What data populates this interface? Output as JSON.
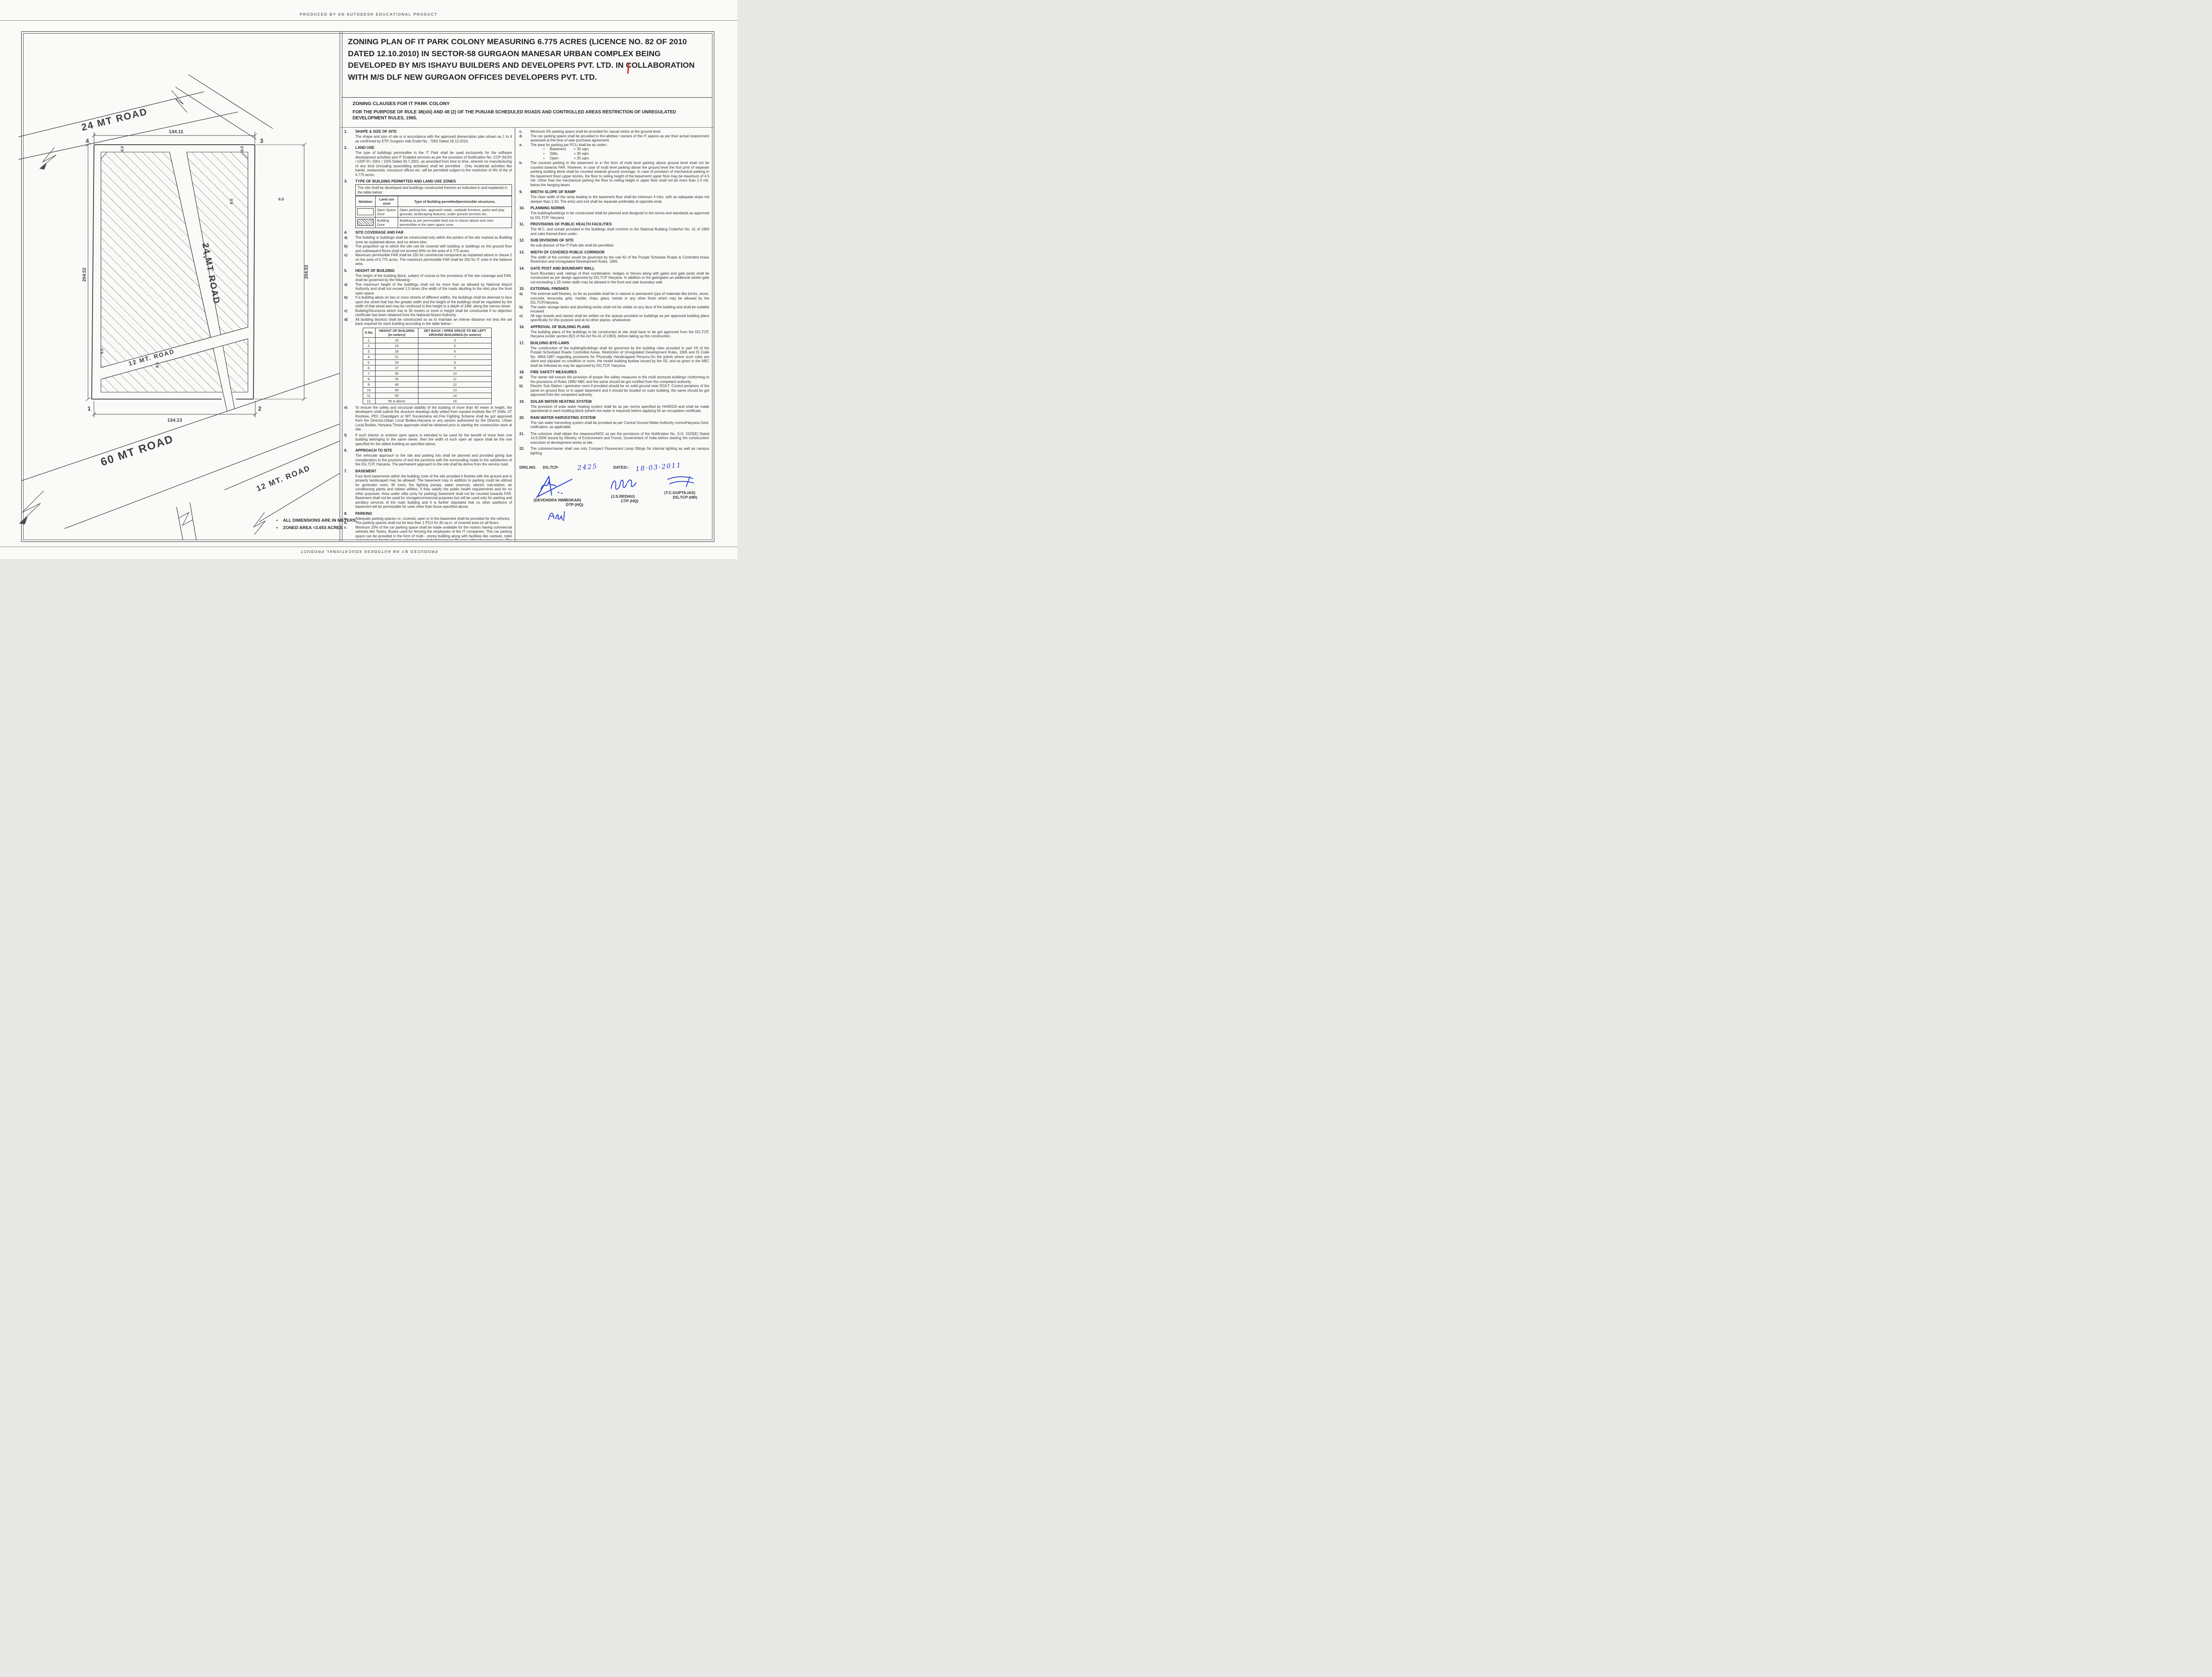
{
  "producer": {
    "top": "PRODUCED BY AN AUTODESK EDUCATIONAL PRODUCT",
    "bottom": "PRODUCED BY AN AUTODESK EDUCATIONAL PRODUCT"
  },
  "title": "ZONING PLAN OF IT PARK COLONY  MEASURING 6.775 ACRES (LICENCE NO. 82 OF 2010 DATED 12.10.2010)  IN SECTOR-58 GURGAON MANESAR URBAN COMPLEX BEING DEVELOPED BY M/S ISHAYU BUILDERS AND DEVELOPERS PVT. LTD. IN COLLABORATION WITH M/S DLF NEW GURGAON OFFICES DEVELOPERS PVT. LTD.",
  "header": {
    "subtitle": "ZONING CLAUSES FOR IT PARK COLONY",
    "purpose": "FOR THE PURPOSE OF RULE 38(xlii) AND 48 (2) OF THE PUNJAB SCHEDULED ROADS AND  CONTROLLED AREAS RESTRICTION OF UNREGULATED DEVELOPMENT RULES, 1965."
  },
  "left": {
    "s1": {
      "no": "1.",
      "title": "SHAPE & SIZE OF SITE",
      "p1": "The shape and size of site is in accordance with the approved demarcation plan shown as 1 to 4 as confirmed by DTP Gurgaon vide  Endst No . 7062 Dated 18.12.2010."
    },
    "s2": {
      "no": "2.",
      "title": "LAND USE",
      "p1": "The type of buildings permissible in the IT Park shall be used exclusively for the software development activities and IT Enabled services as per the provision of Notification No. CCP (NCR) / GDP-III / 2001 / 1555 Dated 30.7.2001, as amended from time to time, wherein no manufacturing of any kind (including assembling activities) shall be permitted . Only incidental activities like banks, restaurants, insurance offices etc. will be permitted subject to the restriction of 4% of the of 6.775 acres."
    },
    "s3": {
      "no": "3.",
      "title": "TYPE OF BUILDING PERMITTED AND LAND USE ZONES",
      "box_intro": "The site shall be developed and buildings constructed thereon as indicated in and explained  in the table below:"
    },
    "s4": {
      "no": "4.",
      "title": "SITE COVERAGE AND FAR",
      "items": [
        {
          "l": "a)",
          "t": "The building or buildings shall be constructed only within the portion of the site marked as Building zone  as explained above, and no where else."
        },
        {
          "l": "b)",
          "t": "The proportion up to which the site can be covered with building or buildings on the ground floor and subsequent floors shall not exceed 40% on the area of 6.775 acres."
        },
        {
          "l": "c)",
          "t": "Maximum permissible FAR shall be 150 for commercial component as explained above in  clause 2 on the area of 6.775 acres. The maximum permissible FAR shall be 250 for IT units in the balance area."
        }
      ]
    },
    "s5": {
      "no": "5.",
      "title": "HEIGHT OF BUILDING",
      "intro": "The height of the building block, subject of course to the provisions of the site coverage and FAR, shall be governed by the following:-",
      "items": [
        {
          "l": "a)",
          "t": "The maximum height of the buildings shall not be more than as allowed by National Airport Authority and shall not  exceed 1.5 times (the width of the roads abutting to the site) plus  the front open space."
        },
        {
          "l": "b)",
          "t": "If a building abuts on two or more streets of different widths, the buildings shall be deemed to face upon the street that has the greater width and the height of the buildings shall be regulated by the width of that street and may be continued to this height to a depth of 24M, along the narrow street."
        },
        {
          "l": "c)",
          "t": "Building/Structures which rise to 30 meters or more in height shall be constructed if no objection certificate has been obtained from the National Airport Authority."
        },
        {
          "l": "d)",
          "t": "All building block(s) shall be constructed so as to maintain an interse distance not less the set back required for each building according to the table below:-"
        }
      ],
      "items2": [
        {
          "l": "e)",
          "t": "To ensure fire safety and structural stability of the building of more than 60 meter in height, the developers shall submit the structure drawings dully vetted from reputed institute like IIT Delhi, IIT Roorkee, PEC Chandigarh or NIT Kurukshetra etc.Fire Fighting Scheme shall be got approved from the Director,Urban Local Bodies,Haryana or any person authorized by the Director, Urban Local Bodies, Haryana.These approvals shall be obtained prior to starting the construction work at site."
        },
        {
          "l": "f)",
          "t": "If such interior or exterior open space is intended to be used for the benefit of more than one building belonging to the same owner, then the width of such open air space  shall be the one specified for the tallest building as specified above."
        }
      ]
    },
    "s6": {
      "no": "6.",
      "title": "APPROACH TO SITE",
      "p1": "The vehicular approach to the site and parking lots shall be planned and provided giving due consideration to the junctions of and the junctions with the surrounding roads to the satisfaction of the DG,TCP, Haryana. The permanent approach to the site shall be derive from the service road."
    },
    "s7": {
      "no": "7.",
      "title": "BASEMENT",
      "p1": "Four level basements within the building zone of the site provided it flushes with the  ground and is properly landscaped may be allowed. The basement may in addition to  parking could be utilized for generator room, lift room, fire fighting pumps, water  reservoir, electric sub-station, air conditioning plants and toilets/ utilities, if they satisfy the  public health requirements and for no other purposes. Area under stilts (only for parking) basement shall not be counted towards FAR. Basement shall not be used for  storage/commercial purposes but will be used only for parking and ancillary services of the main building and  it is further stipulated that no other partitions of basement will be permissible for uses other than those specified above."
    },
    "s8": {
      "no": "8.",
      "title": "PARKING",
      "items": [
        {
          "l": "a.",
          "t": "Adequate parking spaces i.e. covered, open or in the basement shall be provided for the vehicles."
        },
        {
          "l": "b.",
          "t": "The parking spaces shall not be less than 1 PCU for 40 sq.m. of covered area on all floors."
        },
        {
          "l": "c.",
          "t": "Minimum 10% of the car parking space shall be made available for the visitors having commercial vehicles like Taxies, Buses used for ferrying the employees of the IT companies. This car parking space can be provided in the form of multi - storey building along with  facilities like canteen, toilet and rest room for the drivers subject to the limit of maximum 75 sqm, within the zoned area. The parking structure shall also be planned in such a manner that it will maintain the interse distance from the main building and the building of adjoining properties. The above facility shall be free of user charge."
        }
      ]
    }
  },
  "zones_table": {
    "h": [
      "Notation",
      "Land use zone",
      "Type of Building permitted/permissible structures."
    ],
    "rows": [
      {
        "zone": "Open Space Zone",
        "type": "Open parking lots, approach roads, roadside furniture, parks and  play  grounds, landscaping features, under ground services etc."
      },
      {
        "zone": "Building Zone",
        "type": "Building as per permissible land use in clause above and uses permissible in the open space zone."
      }
    ]
  },
  "height_table": {
    "h0": "S.No.",
    "h1a": "HEIGHT OF BUILDING",
    "h1b": "(in meters)",
    "h2a": "SET BACK / OPEN SPACE TO BE LEFT",
    "h2b": "AROUND BUILDINGS.(in meters)",
    "rows": [
      [
        "1.",
        "10",
        "3"
      ],
      [
        "2.",
        "15",
        "5"
      ],
      [
        "3.",
        "18",
        "6"
      ],
      [
        "4.",
        "21",
        "7"
      ],
      [
        "5.",
        "24",
        "8"
      ],
      [
        "6.",
        "27",
        "9"
      ],
      [
        "7.",
        "30",
        "10"
      ],
      [
        "8.",
        "35",
        "11"
      ],
      [
        "9.",
        "40",
        "12"
      ],
      [
        "10.",
        "45",
        "13"
      ],
      [
        "11.",
        "50",
        "14"
      ],
      [
        "12.",
        "55 & above",
        "16"
      ]
    ]
  },
  "right": {
    "c": {
      "l": "c.",
      "t": "Minimum 5% parking space shall be provided for casual visitor at the ground level."
    },
    "d": {
      "l": "d.",
      "t": "The car parking space shall be provided to the allottee / owners of the IT spaces as per their actual requirement assessed at the time of sale purchase agreement."
    },
    "e": {
      "l": "e.",
      "t": "The area for parking per PCU shall be as under:-",
      "b1": "Basement",
      "v1": "= 35 sqm.",
      "b2": "Stilts",
      "v2": "= 30 sqm.",
      "b3": "Open",
      "v3": "= 25 sqm."
    },
    "h": {
      "l": "h.",
      "t": "The covered parking in the basement or in the form of multi level parking above ground level shall not be counted towards FAR. However, in case of multi level parking above the ground level the foot print of separate parking building block shall be counted towards ground coverage. In case of provision of mechanical parking in the basement floor/ upper stories, the floor to ceiling height of the basement/ upper floor may be maximum of 4.5 mtr. Other than the mechanical parking the floor to ceiling height in upper floor shall not be more than 2.4 mtr. below the hanging beam."
    },
    "s9": {
      "no": "9.",
      "title": "WIDTH/ SLOPE OF RAMP",
      "p1": "The clear width of the ramp leading to the basement floor shall be minimum 4 mtrs. with an adequate slope not steeper than 1:10. The entry and exit shall be separate preferably at opposite ends."
    },
    "s10": {
      "no": "10.",
      "title": "PLANNING NORMS",
      "p1": "The building/buildings to be constructed shall be planned and designed to the norms and standards as approved by DG,TCP, Haryana."
    },
    "s11": {
      "no": "11.",
      "title": "PROVISIONS OF PUBLIC HEALTH FACILITIES",
      "p1": "The W.C. and urinals provided in the buildings shall conform to the National Building Code/Act No. 41  of 1963 and rules framed there under."
    },
    "s12": {
      "no": "12.",
      "title": "SUB DIVISIONS OF SITE",
      "p1": "No sub division of the IT Park site shall be permitted."
    },
    "s13": {
      "no": "13.",
      "title": "WIDTH OF COVERED PUBLIC CORRIDOR",
      "p1": "The width of the corridor would be governed by the rule 82 of the Punjab Schedule Roads & Controlled Areas Restriction and Unregulated Development Rules, 1965."
    },
    "s14": {
      "no": "14.",
      "title": "GATE POST AND BOUNDARY WALL",
      "p1": "Such Boundary wall, railings of their combination, hedges or fences along with gates and gate posts shall be constructed as per design approved by DG,TCP Haryana. In addition to the gate/gates an additional wicket gate not exceeding 1.25 meter width may be allowed in the front and side  boundary wall."
    },
    "s15": {
      "no": "15.",
      "title": "EXTERNAL FINISHES",
      "items": [
        {
          "l": "a)",
          "t": "The external wall finishes, so far as possible shall be in natural or permanent type of materials like bricks, stone, concrete, terracotta, grits, marble, chips, glass, metals or any other finish which may   be allowed by the DG,TCP,Haryana."
        },
        {
          "l": "b)",
          "t": "The water storage tanks and plumbing works shall not be visible on any face of the building and  shall be suitable encased."
        },
        {
          "l": "c)",
          "t": "All sign boards and names shall be written on the spaces provided on buildings as per approved building plans specifically for this purpose and at no other places, whatsoever."
        }
      ]
    },
    "s16": {
      "no": "16.",
      "title": "APPROVAL OF BUILDING PLANS",
      "p1": "The building plans of the buildings to be constructed at site shall have to be got approved from the DG,TCP, Haryana (under section 8(2) of the Act No.41 of 1963), before taking up the construction."
    },
    "s17": {
      "no": "17.",
      "title": "BUILDING BYE-LAWS",
      "p1": "The construction of the building/buildings shall be governed by the building rules provided in part  VII of the Punjab Scheduled Roads Controlled Areas, Restriction of Unregulated Development Rules, 1965 and IS Code No. 4963-1987 regarding provisions for Physically Handicapped Persons.On  the points where such rules are silent   and stipulate no condition or norm, the model building byelaw issued by the ISI, and as given in the NBC shall be followed as may be approved by DG,TCP, Haryana."
    },
    "s18": {
      "no": "18.",
      "title": "FIRE SAFETY MEASURES",
      "items": [
        {
          "l": "a)",
          "t": "The owner will ensure the provision of proper fire safety measures in the multi storeyed buildings  conforming to the provisions of  Rules 1965/ NBC and the same should be got certified from the  competent authority."
        },
        {
          "l": "b)",
          "t": "Electric Sub Station / generator room if provided should be on solid ground near DG/LT. Control   periphery of the panel on ground floor or in upper basement and it should be located on outer building, the same should be got approved from the competent authority."
        }
      ]
    },
    "s19": {
      "no": "19.",
      "title": "SOLAR WATER HEATING SYSTEM",
      "p1": "The provision of solar water heating system shall be as per norms specified by HAREDA  and shall be made operational in each building block (where hot water is required) before applying for an occupation certificate."
    },
    "s20": {
      "no": "20.",
      "title": "RAIN WATER HARVESTING SYSTEM",
      "p1": "The rain water harvesting system shall be provided as per Central Ground Water Authority norms/Haryana Govt. notification, as applicable."
    },
    "s21": {
      "no": "21.",
      "p1": "The colonizer shall obtain the clearance/NOC as per the provisions of the Notification  No. S.O. 1533(E) Dated 14.9.2006 issued by Ministry of Environment and Forest, Government of India before starting the construction/ execution of development  works at site."
    },
    "s22": {
      "no": "22.",
      "p1": "The coloniser/owner shall use only Compact Fluorescent Lamp fittings for internal lighting as well as campus lighting."
    }
  },
  "sign": {
    "drg_label": "DRG.NO.",
    "dg_label": "DG,TCP-",
    "drg_no": "2425",
    "dated_label": "DATED:-",
    "date": "18·03·2011",
    "names": [
      {
        "name": "(DEVENDRA NIMBOKAR)",
        "title": "DTP (HQ)"
      },
      {
        "name": "(J.S.REDHU)",
        "title": "CTP (HQ)"
      },
      {
        "name": "(T.C.GUPTA,IAS)",
        "title": "DG,TCP (HR)"
      }
    ]
  },
  "plan": {
    "road_24_outer": "24 MT ROAD",
    "road_24_inner": "24 MT ROAD",
    "road_12_inner": "12 MT. ROAD",
    "road_60": "60 MT ROAD",
    "road_12_outer": "12 MT. ROAD",
    "dim_top": "134.11",
    "dim_bottom": "134.13",
    "dim_left": "204.52",
    "dim_right": "204.52",
    "c1": "1",
    "c2": "2",
    "c3": "3",
    "c4": "4",
    "off1": "6.0",
    "off2": "6.0",
    "off3": "6.0",
    "off4": "6.0",
    "off5": "6.0",
    "off6": "6.0",
    "off7": "8.0",
    "note1": "ALL DIMENSIONS ARE IN METERS.",
    "note2": "ZONED AREA =3.653 ACRES"
  }
}
